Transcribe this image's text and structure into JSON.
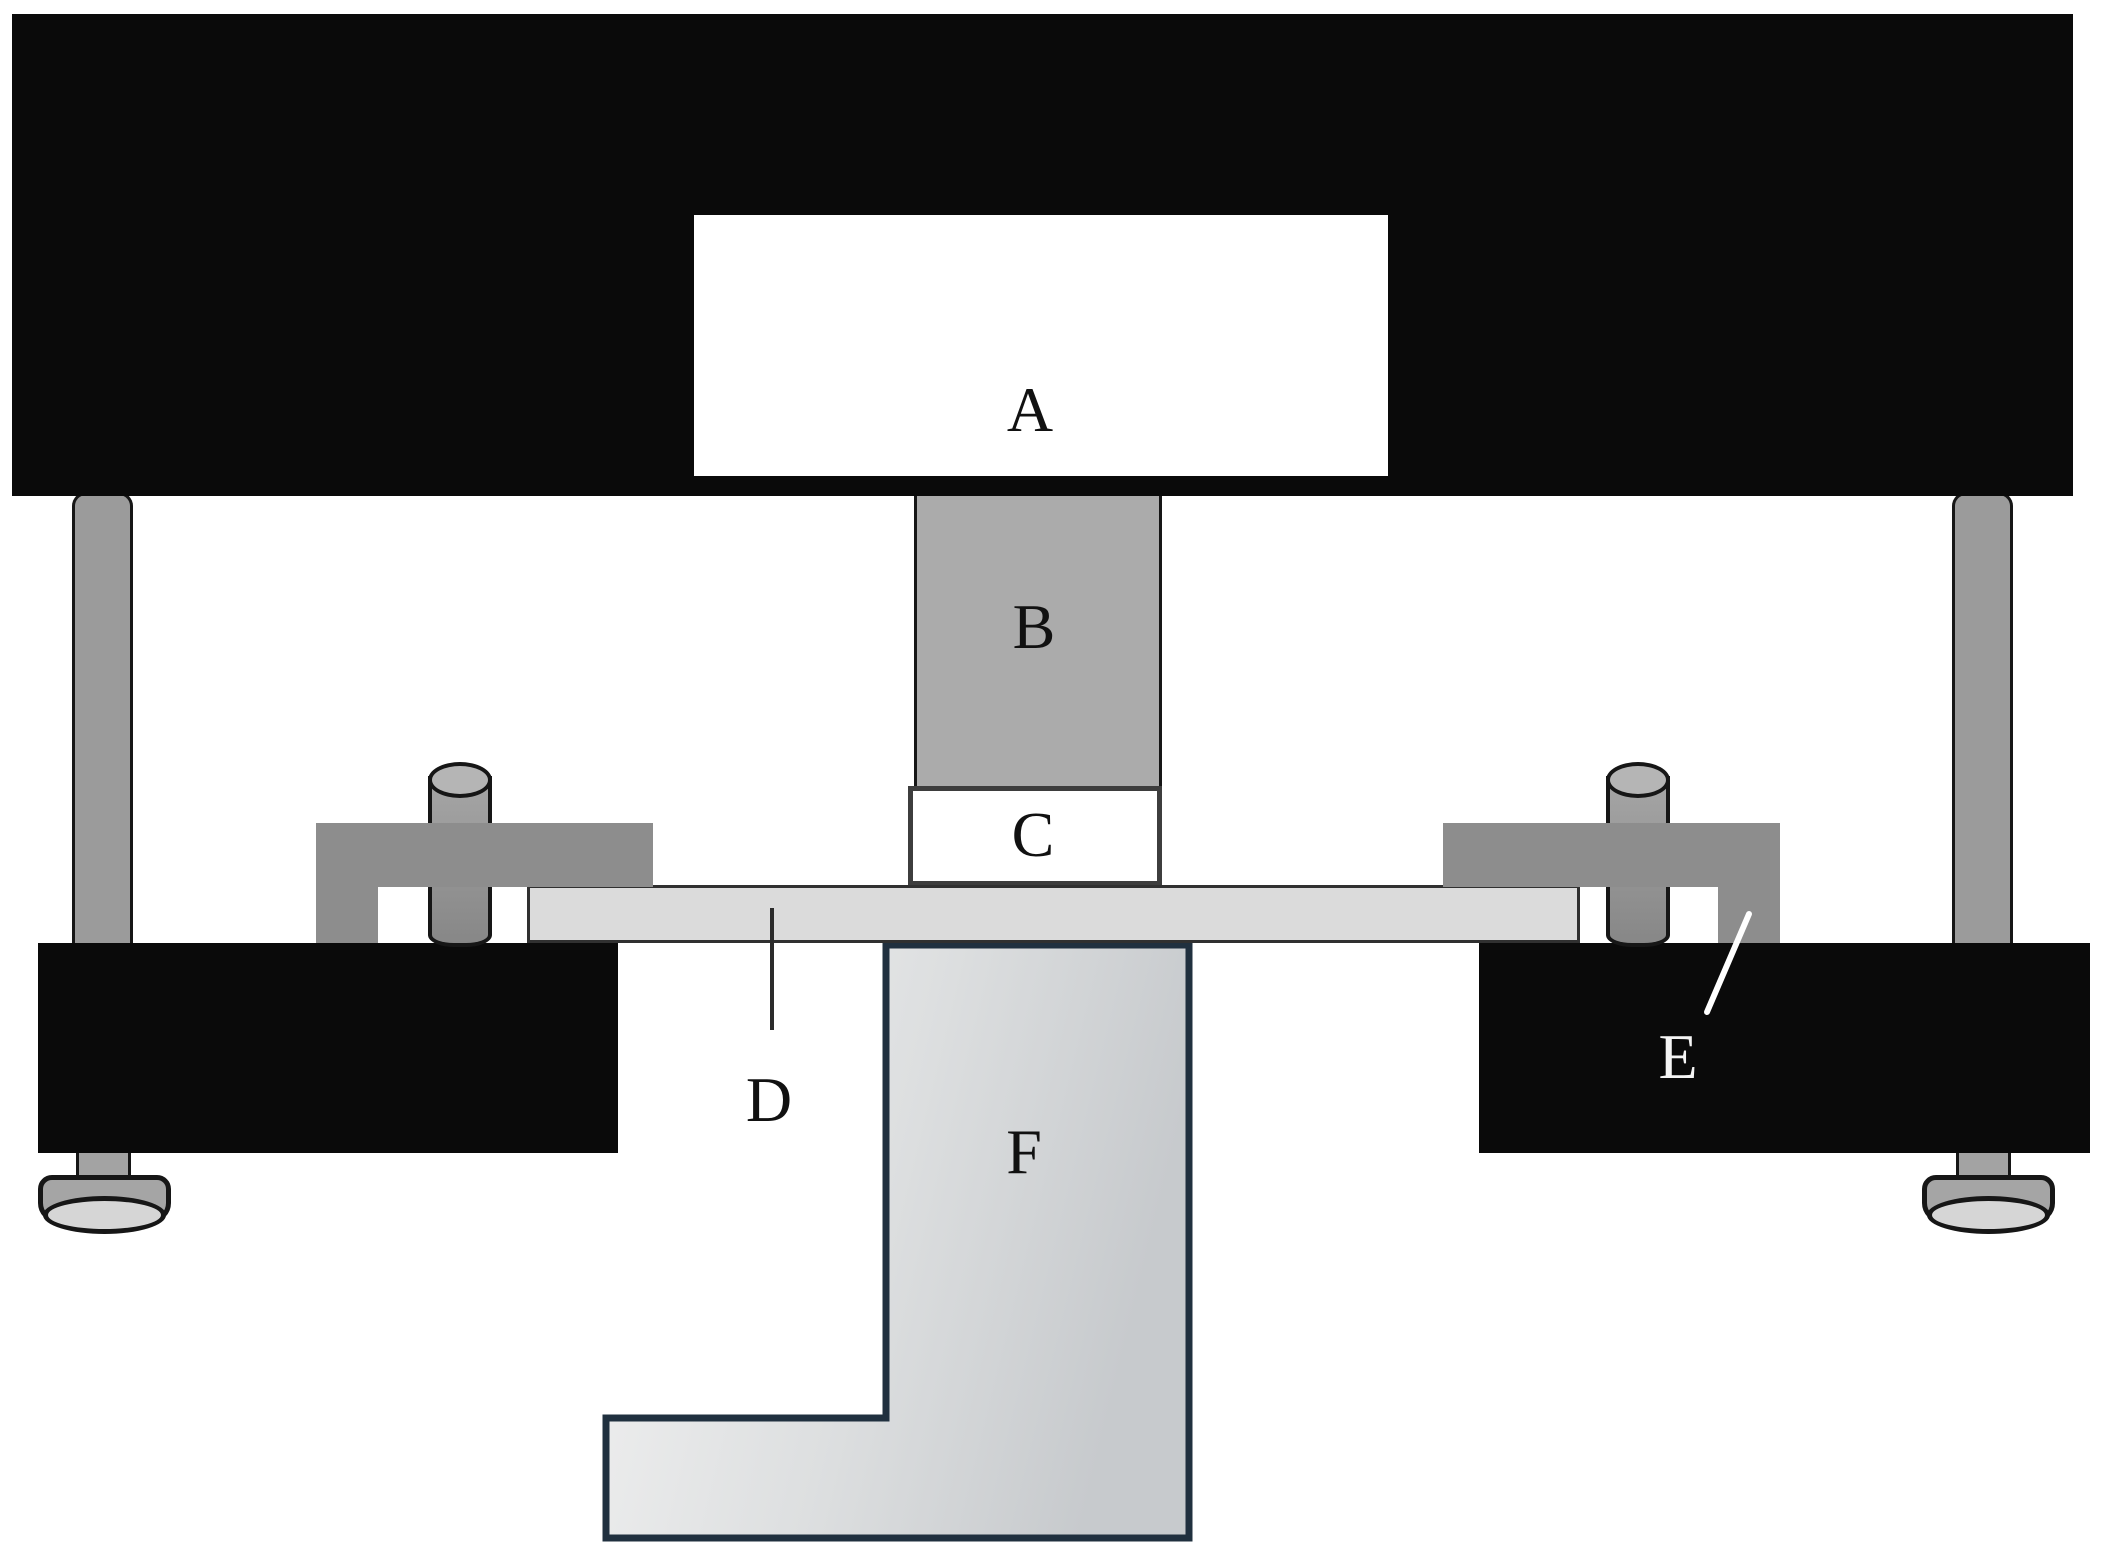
{
  "figure": {
    "type": "apparatus-schematic",
    "labels": {
      "A": "A",
      "B": "B",
      "C": "C",
      "D": "D",
      "E": "E",
      "F": "F"
    }
  },
  "colors": {
    "bg": "#ffffff",
    "block-black": "#0a0a0a",
    "part-b-gray": "#ababab",
    "part-c-white": "#ffffff",
    "plate-gray": "#dbdbdb",
    "clamp-gray": "#8d8d8d",
    "rod-gray": "#9b9b9b",
    "foot-gray": "#a5a5a5",
    "foot-ellipse": "#d6d6d6",
    "outline-dark": "#161616",
    "f-border-navy": "#20303f",
    "f-fill-light": "#f2f2f2",
    "f-fill-dark": "#c7cacd",
    "pointer-dark": "#2b2b2b",
    "pointer-white": "#ffffff",
    "label-dark": "#111111",
    "label-white": "#f5f5f5"
  }
}
